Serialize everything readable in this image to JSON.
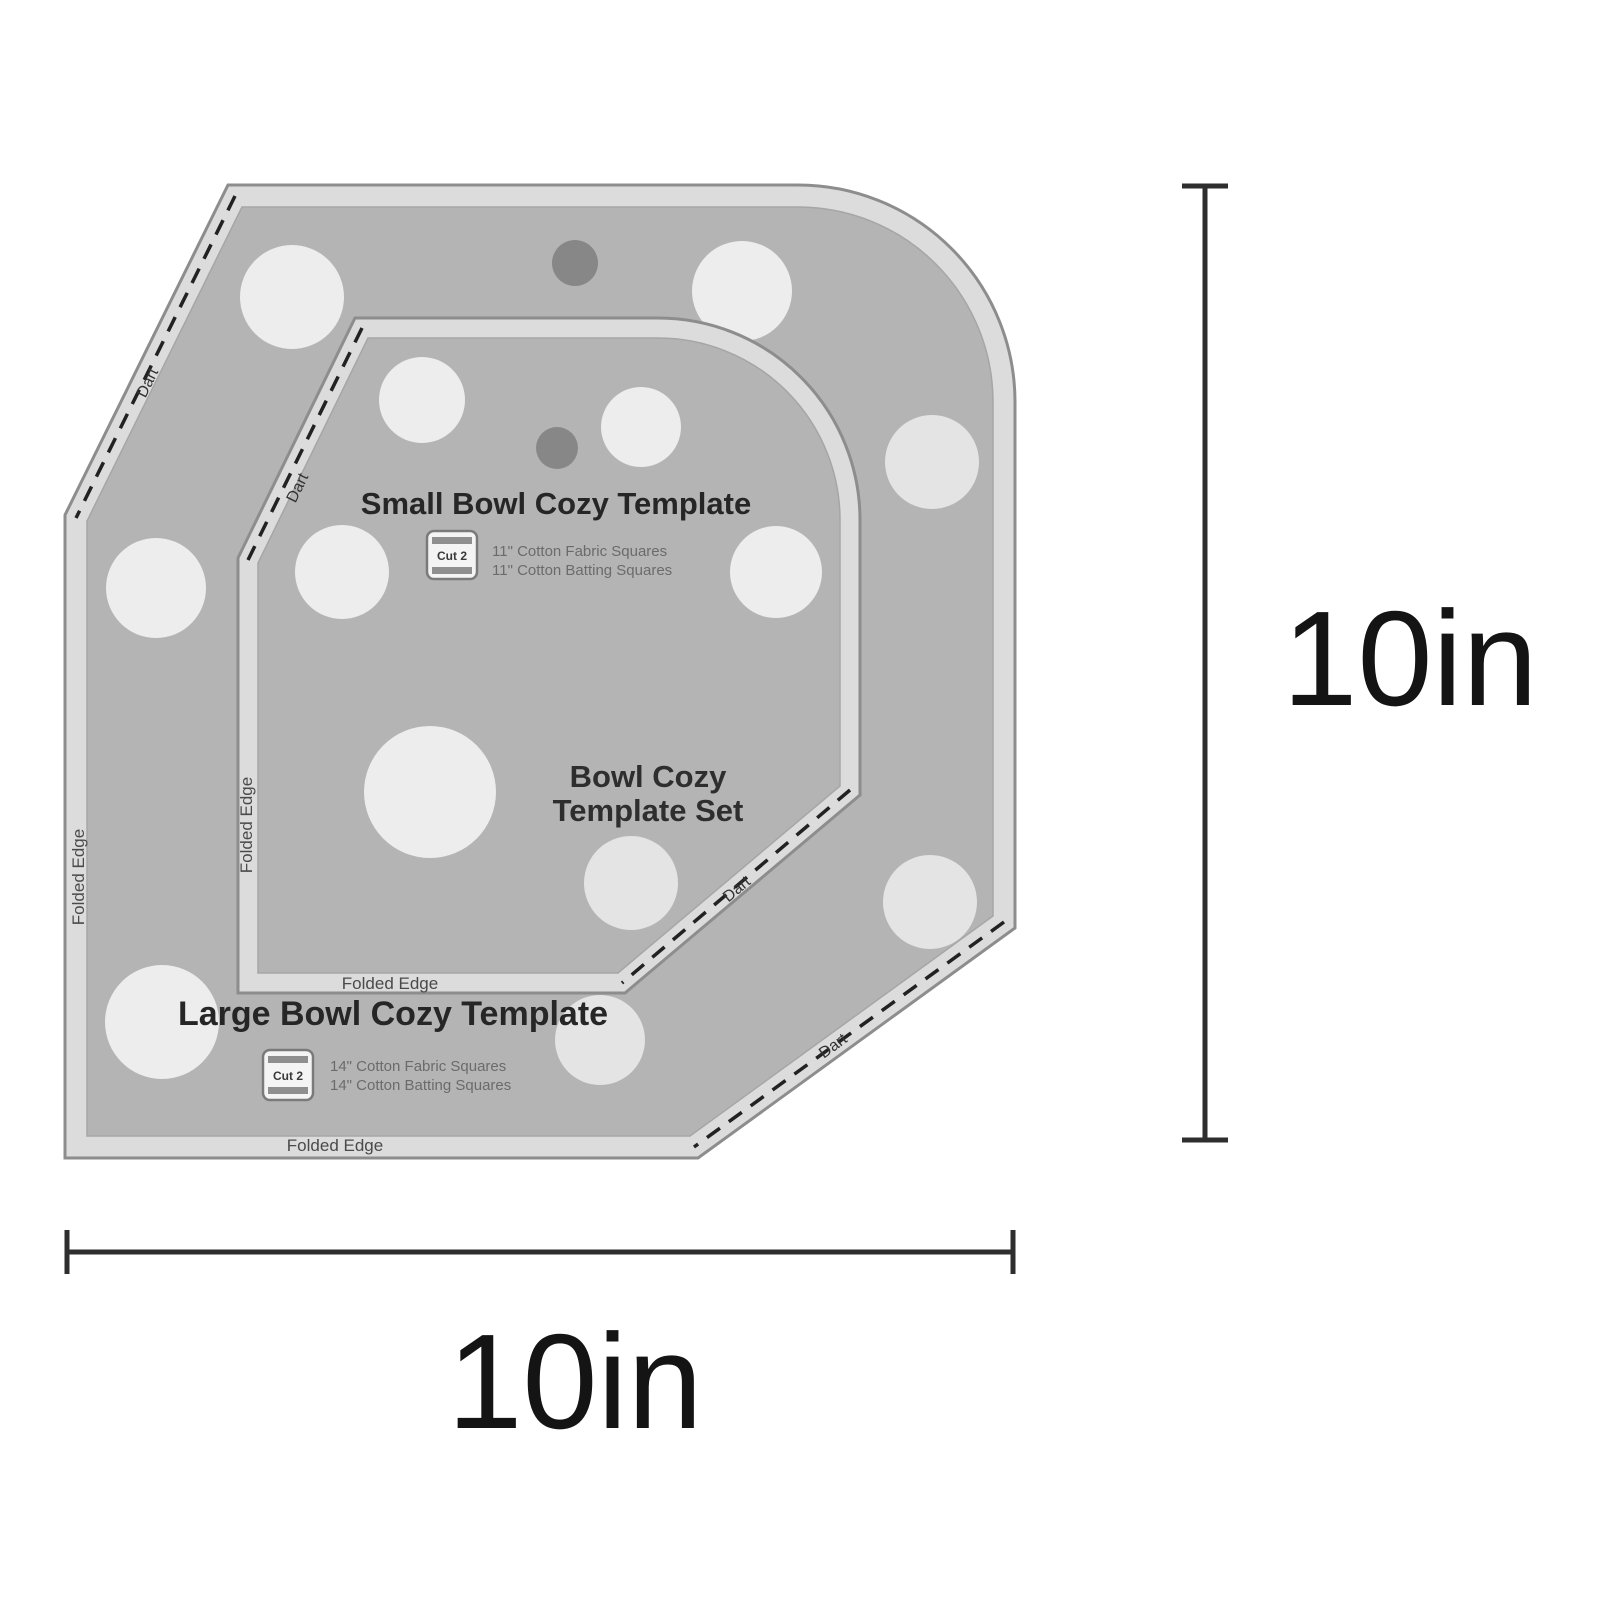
{
  "image": {
    "description": "Bowl cozy quilting template set product diagram with size callouts",
    "background": "#ffffff"
  },
  "set_label": {
    "line1": "Bowl Cozy",
    "line2": "Template Set"
  },
  "small_template": {
    "title": "Small Bowl Cozy Template",
    "cut_badge": "Cut 2",
    "material_line1": "11\" Cotton Fabric Squares",
    "material_line2": "11\" Cotton Batting Squares",
    "folded_edge_bottom": "Folded Edge",
    "folded_edge_left": "Folded Edge",
    "dart_top_left": "Dart",
    "dart_bottom_right": "Dart"
  },
  "large_template": {
    "title": "Large Bowl Cozy Template",
    "cut_badge": "Cut 2",
    "material_line1": "14\" Cotton Fabric Squares",
    "material_line2": "14\" Cotton Batting Squares",
    "folded_edge_bottom": "Folded Edge",
    "folded_edge_left": "Folded Edge",
    "dart_top_left": "Dart",
    "dart_bottom_right": "Dart"
  },
  "dimensions": {
    "width": "10in",
    "height": "10in"
  },
  "colors": {
    "template_body": "#b4b4b4",
    "template_edge_band": "#dcdcdc",
    "edge_outline": "#8d8d8d",
    "polka_dot": "#ededed",
    "hang_hole": "#878787",
    "dimension_line": "#2e2e2e",
    "title_text": "#262626",
    "small_print": "#6b6b6b"
  }
}
